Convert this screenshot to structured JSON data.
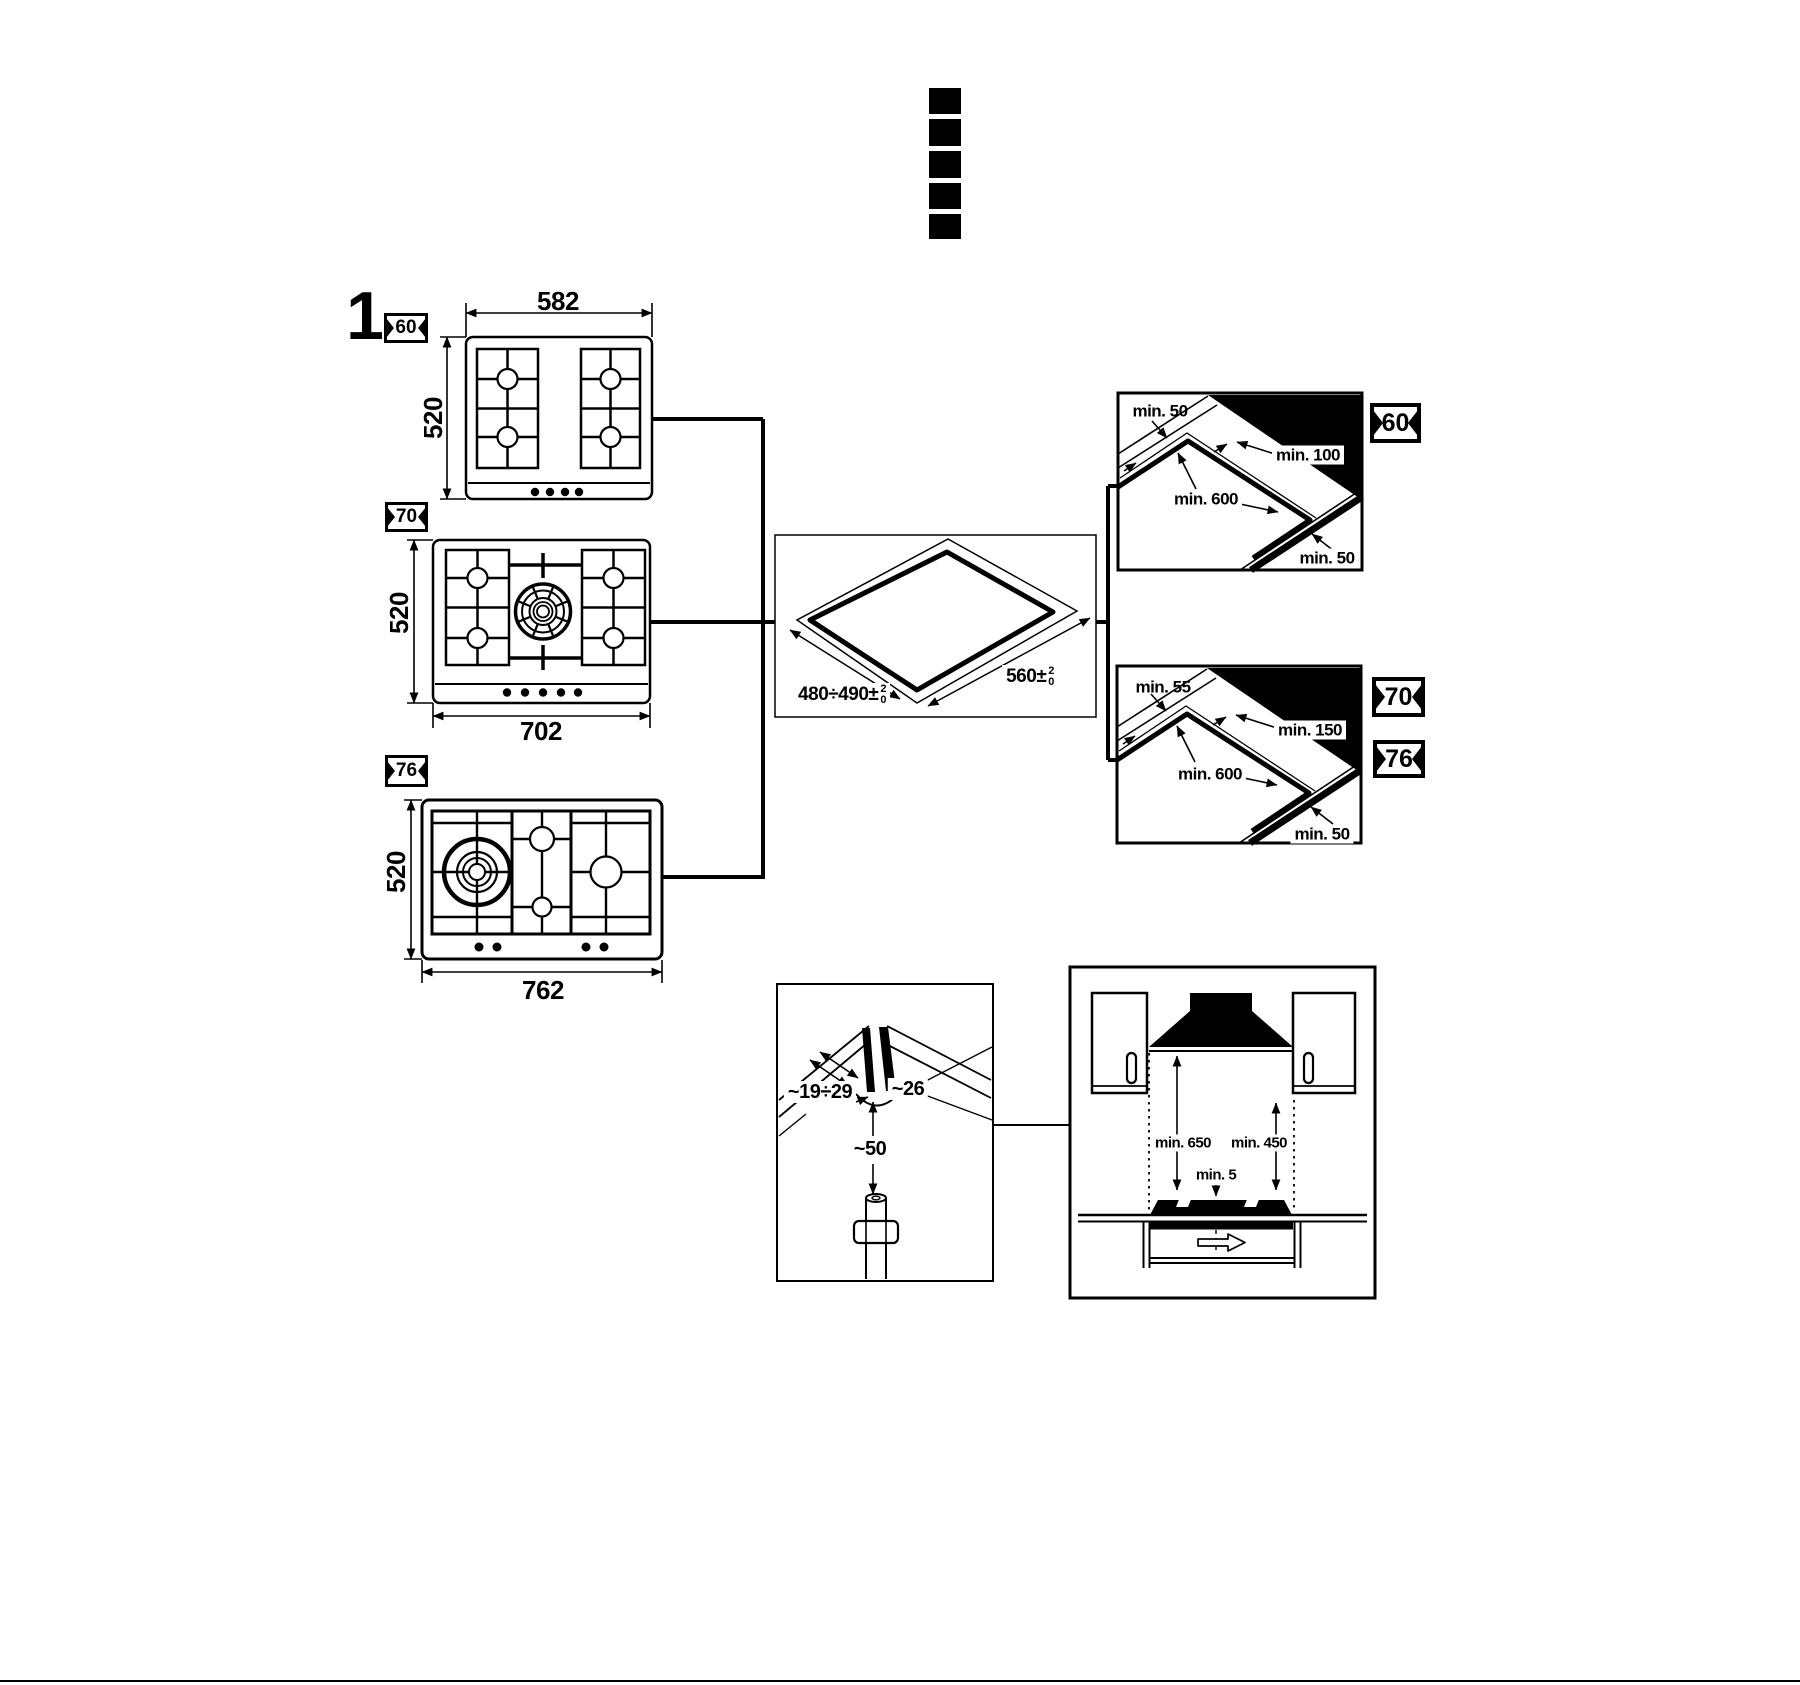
{
  "figure_label": "1",
  "fold_marks_count": 5,
  "hob_60": {
    "badge": "60",
    "width_mm": "582",
    "depth_mm": "520"
  },
  "hob_70": {
    "badge": "70",
    "width_mm": "702",
    "depth_mm": "520"
  },
  "hob_76": {
    "badge": "76",
    "width_mm": "762",
    "depth_mm": "520"
  },
  "worktop_cutout": {
    "depth_label": "480÷490±",
    "width_label": "560±",
    "tol_upper": "2",
    "tol_lower": "0"
  },
  "clearance_60": {
    "badge": "60",
    "side": "min. 50",
    "rear": "min. 100",
    "length": "min. 600",
    "front": "min. 50"
  },
  "clearance_70_76": {
    "badge_70": "70",
    "badge_76": "76",
    "side": "min. 55",
    "rear": "min. 150",
    "length": "min. 600",
    "front": "min. 50"
  },
  "gas_connection": {
    "hole_depth": "~19÷29",
    "hole_width": "~26",
    "pipe_clearance": "~50"
  },
  "hood": {
    "hood_clearance": "min. 650",
    "cabinet_clearance": "min. 450",
    "base_gap": "min. 5"
  }
}
